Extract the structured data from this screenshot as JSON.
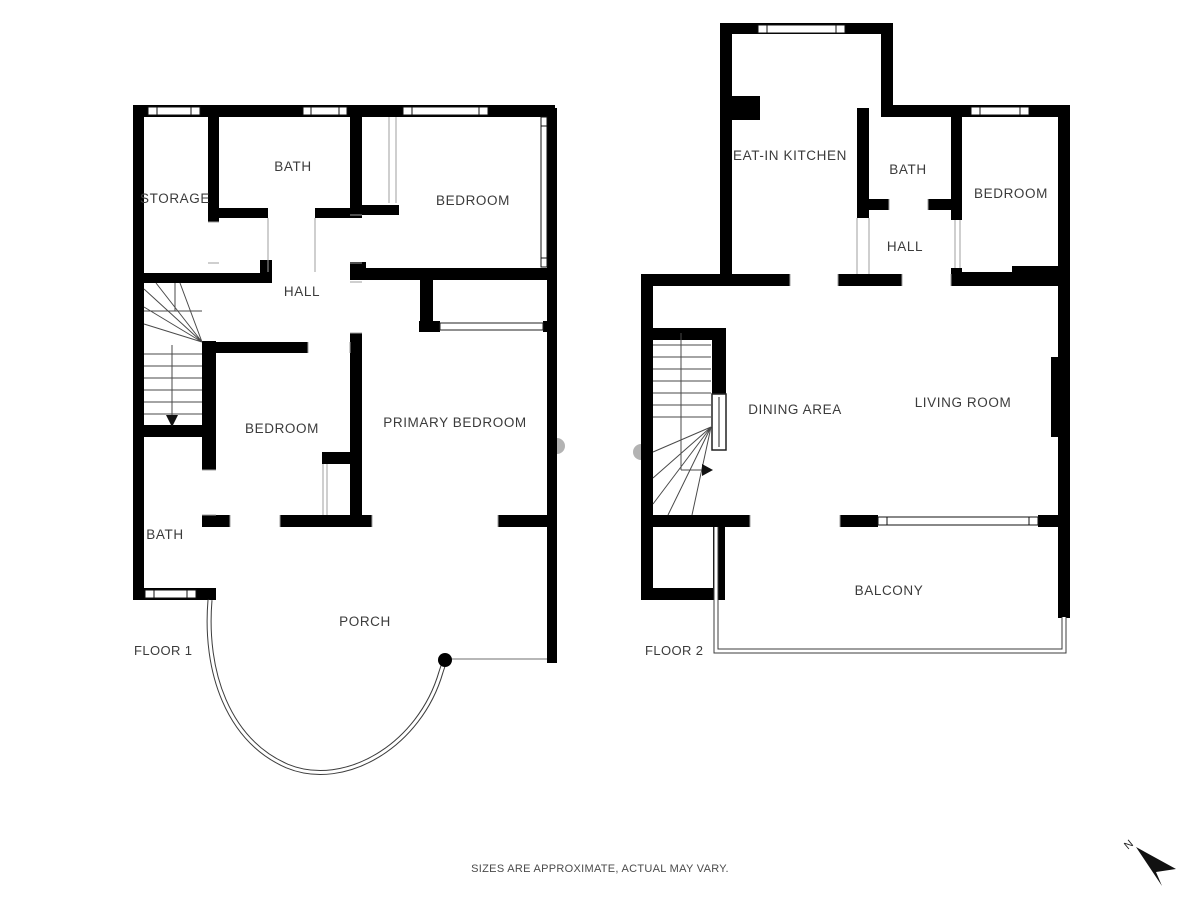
{
  "page": {
    "disclaimer": "SIZES ARE APPROXIMATE, ACTUAL MAY VARY."
  },
  "colors": {
    "wall": "#000000",
    "background": "#ffffff",
    "label_text": "#3b3b3b",
    "thin_line": "#4a4a4a",
    "door_jamb": "#9f9f9f",
    "exterior_marker": "#b3b3b3"
  },
  "north_indicator": {
    "label": "N"
  },
  "floors": [
    {
      "label": "FLOOR 1",
      "rooms": [
        {
          "name": "storage",
          "label": "STORAGE"
        },
        {
          "name": "bath-upper",
          "label": "BATH"
        },
        {
          "name": "bedroom-upper",
          "label": "BEDROOM"
        },
        {
          "name": "hall",
          "label": "HALL"
        },
        {
          "name": "bedroom-middle",
          "label": "BEDROOM"
        },
        {
          "name": "primary-bedroom",
          "label": "PRIMARY BEDROOM"
        },
        {
          "name": "bath-lower",
          "label": "BATH"
        },
        {
          "name": "porch",
          "label": "PORCH"
        }
      ]
    },
    {
      "label": "FLOOR 2",
      "rooms": [
        {
          "name": "eat-in-kitchen",
          "label": "EAT-IN KITCHEN"
        },
        {
          "name": "bath",
          "label": "BATH"
        },
        {
          "name": "bedroom",
          "label": "BEDROOM"
        },
        {
          "name": "hall",
          "label": "HALL"
        },
        {
          "name": "dining-area",
          "label": "DINING AREA"
        },
        {
          "name": "living-room",
          "label": "LIVING ROOM"
        },
        {
          "name": "balcony",
          "label": "BALCONY"
        }
      ]
    }
  ]
}
